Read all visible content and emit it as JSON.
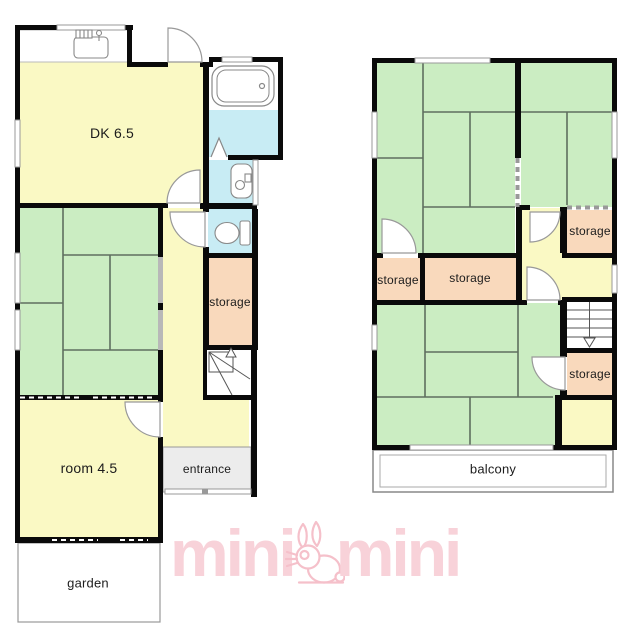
{
  "document_type": "floor-plan",
  "colors": {
    "room_yellow": "#FAF9C4",
    "tatami_green": "#CBEDC2",
    "tatami_line": "#5f6f5f",
    "storage_orange": "#F9D9BC",
    "bath_blue": "#C8ECF4",
    "entrance_gray": "#ECECEC",
    "wall_black": "#0a0a0a",
    "window_gray": "#999999",
    "watermark_pink": "#F8D2D9"
  },
  "floor1": {
    "labels": {
      "dk": "DK 6.5",
      "storage": "storage",
      "room45": "room 4.5",
      "entrance": "entrance",
      "garden": "garden"
    },
    "icons": [
      "kitchen-sink-icon",
      "bathtub-icon",
      "washbasin-icon",
      "toilet-icon",
      "staircase-up-icon",
      "door-arc",
      "folding-door-icon"
    ]
  },
  "floor2": {
    "labels": {
      "storage_left": "storage",
      "storage_middle": "storage",
      "storage_upper_right": "storage",
      "storage_lower_right": "storage",
      "balcony": "balcony"
    },
    "icons": [
      "staircase-down-icon",
      "door-arc"
    ]
  },
  "watermark": {
    "left_word": "mini",
    "right_word": "mini",
    "mascot": "rabbit"
  }
}
